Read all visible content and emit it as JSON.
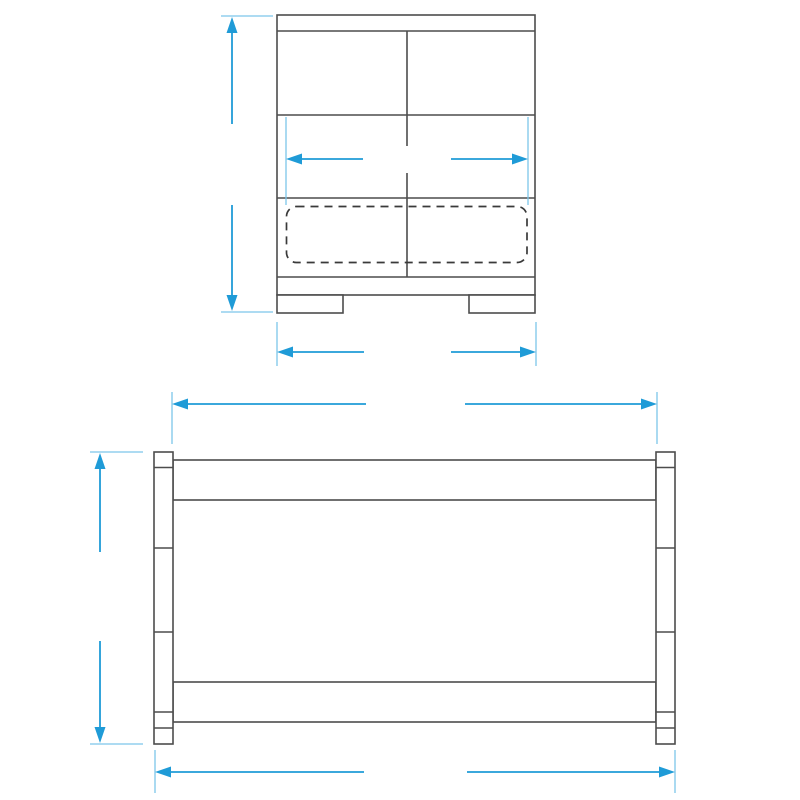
{
  "title": "Cot bed dimension diagram",
  "colors": {
    "dimension_accent": "#1f9bd7",
    "extension_line": "#7cc5e9",
    "furniture_outline": "#4d4d4d",
    "mattress_fill": "#f1eff0",
    "background": "#ffffff"
  },
  "end_view": {
    "name": "cot end view",
    "dims": {
      "height": "82 cm",
      "inner_width": "70 cm",
      "outer_width": "76 cm"
    }
  },
  "front_view": {
    "name": "cot front view",
    "slat_openings": 11,
    "dims": {
      "top_width": "140 cm",
      "height": "82 cm",
      "overall_width": "148 cm"
    }
  }
}
